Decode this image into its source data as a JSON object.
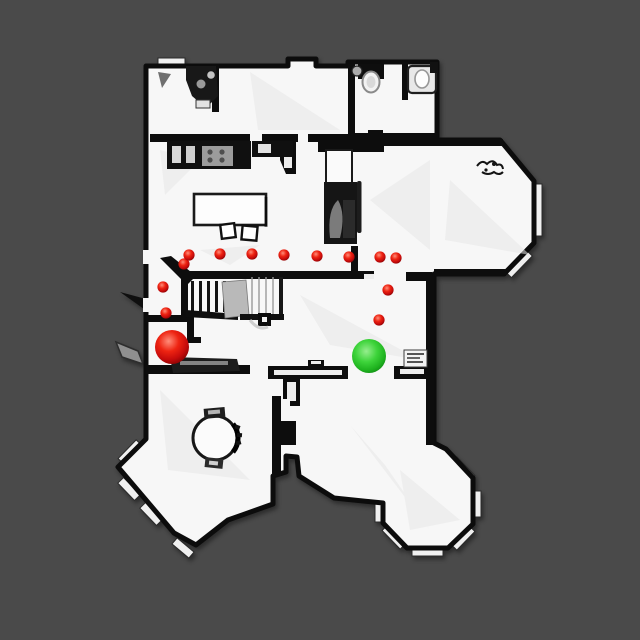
{
  "scene": {
    "title": "top-down-scan-floorplan",
    "background_color": "#4a4a4a",
    "floor_color": "#f7f7f7",
    "wall_color": "#0d0d0d",
    "landing_color": "#b9b9b9"
  },
  "markers": {
    "waypoint_color": "#e01212",
    "start_color": "#e01212",
    "goal_color": "#2ec62e",
    "waypoint_radius": 5.6,
    "waypoints": [
      {
        "x": 184,
        "y": 264
      },
      {
        "x": 189,
        "y": 255
      },
      {
        "x": 220,
        "y": 254
      },
      {
        "x": 252,
        "y": 254
      },
      {
        "x": 284,
        "y": 255
      },
      {
        "x": 317,
        "y": 256
      },
      {
        "x": 349,
        "y": 257
      },
      {
        "x": 380,
        "y": 257
      },
      {
        "x": 396,
        "y": 258
      },
      {
        "x": 163,
        "y": 287
      },
      {
        "x": 166,
        "y": 313
      },
      {
        "x": 388,
        "y": 290
      },
      {
        "x": 379,
        "y": 320
      }
    ],
    "start": {
      "x": 172,
      "y": 347,
      "radius": 17
    },
    "goal": {
      "x": 369,
      "y": 356,
      "radius": 17
    }
  }
}
